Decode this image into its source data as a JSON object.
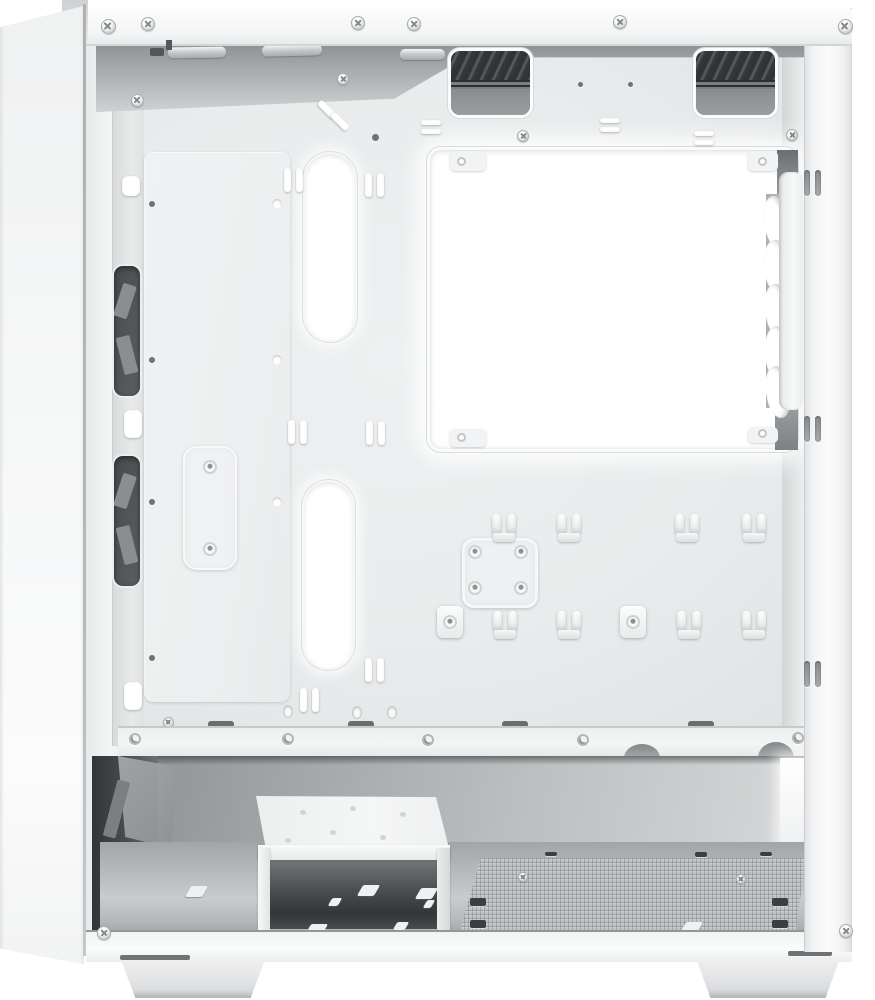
{
  "meta": {
    "type": "product-photo",
    "subject": "White mini-tower PC case shown from the open side, interior view, no visible text"
  },
  "parts": [
    "front-panel",
    "top-panel-vent-cutouts",
    "top-vent-grille",
    "rear-exhaust-fan",
    "cpu-cooler-cutout",
    "cable-routing-slot",
    "cable-tie-hooks",
    "motherboard-tray",
    "ssd-mount-bracket",
    "ssd-mount-plate",
    "front-fan-openings",
    "thumbscrew-keyholes",
    "psu-compartment",
    "psu-dust-filter-mesh",
    "drive-cage",
    "case-feet",
    "philips-screws"
  ],
  "colors": {
    "pageBg": "#ffffff",
    "caseWhite": "#f9f9fa",
    "panelTop": "#f0f1f2",
    "panelBottom": "#fbfbfc",
    "seam": "#b6b8ba",
    "barBg": "#f4f5f5",
    "barEdge": "#d3d5d6",
    "trayBg": "#e9ebec",
    "shadowBand": "#8f9294",
    "fanFrame": "#f7f8f8",
    "fanShade": "#b7babc",
    "compDark": "#8b8e90",
    "compMid": "#bdc0c1",
    "compLight": "#d8dadb",
    "floorBg": "#c9cbcc",
    "meshBg": "#c0c3c4",
    "cageTop": "#f5f6f6",
    "cageDark": "#4a4d4f",
    "footTop": "#f0f0f1",
    "footBottom": "#d4d5d7",
    "screwBody": "#dfe1e2",
    "screwEdge": "#a9abad",
    "holeDark": "#6f7274"
  }
}
